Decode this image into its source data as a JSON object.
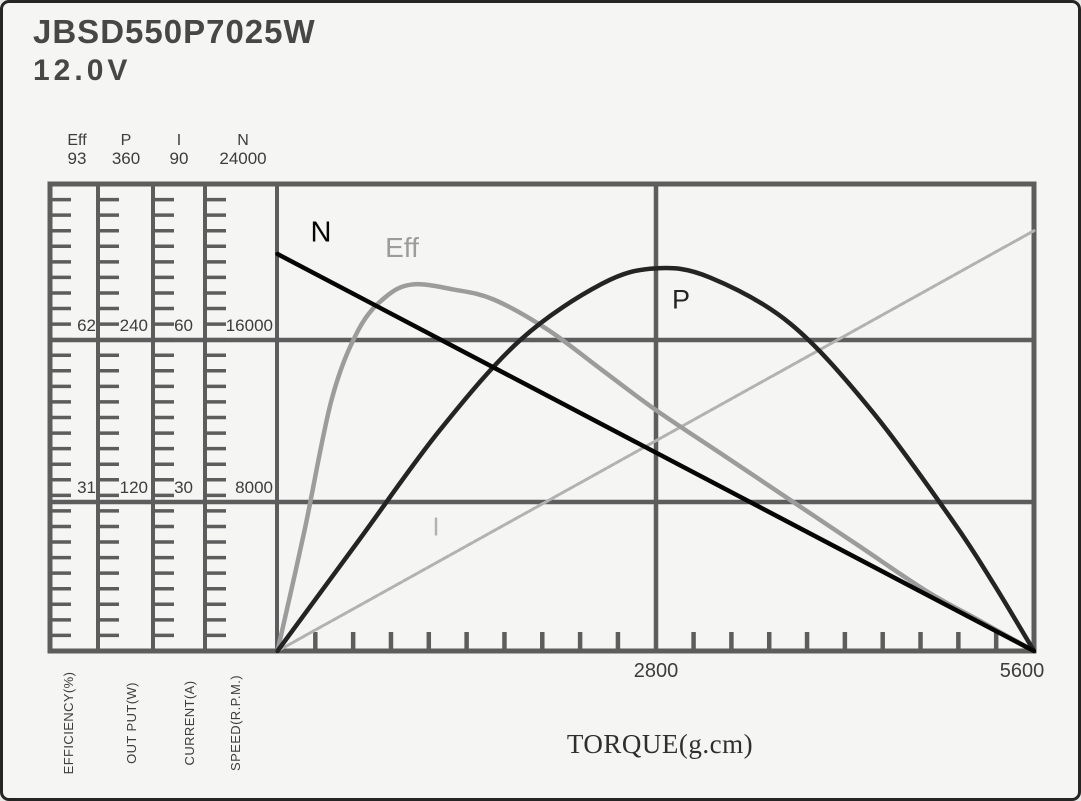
{
  "window": {
    "title": "JBSD550P7025W",
    "voltage": "12.0V"
  },
  "colors": {
    "grid": "#5d5d5d",
    "frame": "#5d5d5d",
    "text": "#3d3d3d",
    "background": "#f5f5f3"
  },
  "chart_data": {
    "type": "line",
    "title": "JBSD550P7025W 12.0V motor performance curves",
    "xlabel": "TORQUE(g.cm)",
    "xlim": [
      0,
      5600
    ],
    "x_tick_labels": [
      "2800",
      "5600"
    ],
    "x_tick_values": [
      2800,
      5600
    ],
    "x_minor_step": 280,
    "grid": "major",
    "legend_position": "inline-curve-labels",
    "axes": [
      {
        "letter": "Eff",
        "name": "EFFICIENCY(%)",
        "max": 93,
        "tick_labels": [
          "93",
          "62",
          "31"
        ],
        "tick_values": [
          93,
          62,
          31
        ]
      },
      {
        "letter": "P",
        "name": "OUT PUT(W)",
        "max": 360,
        "tick_labels": [
          "360",
          "240",
          "120"
        ],
        "tick_values": [
          360,
          240,
          120
        ]
      },
      {
        "letter": "I",
        "name": "CURRENT(A)",
        "max": 90,
        "tick_labels": [
          "90",
          "60",
          "30"
        ],
        "tick_values": [
          90,
          60,
          30
        ]
      },
      {
        "letter": "N",
        "name": "SPEED(R.P.M.)",
        "max": 24000,
        "tick_labels": [
          "24000",
          "16000",
          "8000"
        ],
        "tick_values": [
          24000,
          16000,
          8000
        ]
      }
    ],
    "series": [
      {
        "name": "I",
        "axis": "CURRENT(A)",
        "ylim": [
          0,
          90
        ],
        "color": "#b2b2b2",
        "line_style": "dashed",
        "width": 3,
        "x": [
          0,
          5600
        ],
        "y": [
          0,
          81
        ]
      },
      {
        "name": "Eff",
        "axis": "EFFICIENCY(%)",
        "ylim": [
          0,
          93
        ],
        "color": "#9c9c9c",
        "line_style": "solid",
        "width": 4.5,
        "x": [
          0,
          200,
          400,
          600,
          800,
          1000,
          1300,
          1600,
          2000,
          2400,
          2800,
          3300,
          3800,
          4300,
          4800,
          5200,
          5600
        ],
        "y": [
          0,
          24,
          50,
          64,
          70.5,
          73,
          72,
          70,
          64,
          56,
          48,
          39,
          30,
          21,
          12,
          6,
          0
        ]
      },
      {
        "name": "P",
        "axis": "OUT PUT(W)",
        "ylim": [
          0,
          360
        ],
        "color": "#242424",
        "line_style": "solid",
        "width": 4.5,
        "x": [
          0,
          600,
          1200,
          1800,
          2400,
          2800,
          3200,
          3800,
          4400,
          5000,
          5300,
          5600
        ],
        "y": [
          0,
          85,
          170,
          240,
          283,
          295,
          288,
          252,
          185,
          100,
          52,
          0
        ]
      },
      {
        "name": "N",
        "axis": "SPEED(R.P.M.)",
        "ylim": [
          0,
          24000
        ],
        "color": "#060606",
        "line_style": "solid",
        "width": 4.5,
        "x": [
          0,
          5600
        ],
        "y": [
          20400,
          0
        ]
      }
    ],
    "curve_labels": {
      "n": "N",
      "eff": "Eff",
      "p": "P",
      "i": "I"
    }
  }
}
